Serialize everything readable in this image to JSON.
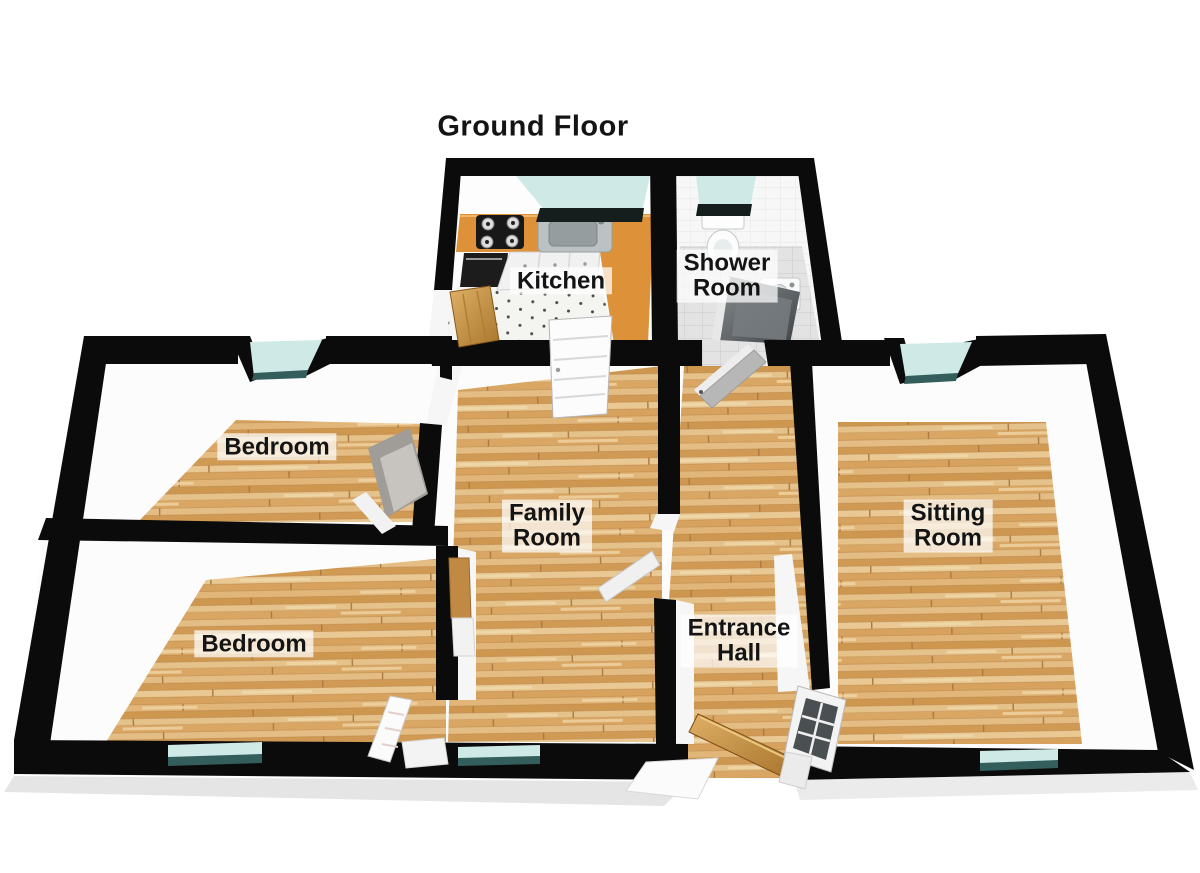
{
  "title": "Ground Floor",
  "rooms": {
    "kitchen": {
      "label": "Kitchen"
    },
    "shower_room": {
      "line1": "Shower",
      "line2": "Room"
    },
    "bedroom_top": {
      "label": "Bedroom"
    },
    "bedroom_bottom": {
      "label": "Bedroom"
    },
    "family_room": {
      "line1": "Family",
      "line2": "Room"
    },
    "sitting_room": {
      "line1": "Sitting",
      "line2": "Room"
    },
    "entrance_hall": {
      "line1": "Entrance",
      "line2": "Hall"
    }
  },
  "colors": {
    "background": "#ffffff",
    "wall": "#0b0b0b",
    "wall_inner_face": "#f6f6f6",
    "wood_floor": "#dcae72",
    "wood_plank_dark": "#c6934f",
    "wood_plank_light": "#ecd09e",
    "window_glass": "#cfe9e7",
    "window_glass_dark": "#335e5c",
    "kitchen_counter": "#dd9138",
    "kitchen_tile": "#f4f4f1",
    "kitchen_appliance_dark": "#1c1c1c",
    "shower_floor_tile": "#e3e3e3",
    "shower_wall_tile": "#f7f7f7",
    "shower_glass": "#4a4f52",
    "door_wood": "#c8953f",
    "door_white": "#fbfbfb",
    "label_text": "#141414",
    "label_background": "rgba(255,255,255,0.72)"
  }
}
